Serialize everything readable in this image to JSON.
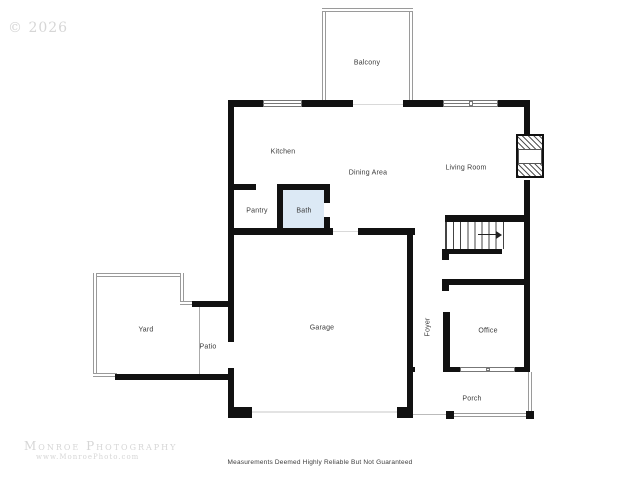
{
  "watermarks": {
    "copyright": "© 2026",
    "studio": "Monroe Photography",
    "studio_url": "www.MonroePhoto.com"
  },
  "disclaimer": "Measurements Deemed Highly Reliable But Not Guaranteed",
  "rooms": {
    "balcony": "Balcony",
    "kitchen": "Kitchen",
    "dining": "Dining Area",
    "living": "Living Room",
    "pantry": "Pantry",
    "bath": "Bath",
    "yard": "Yard",
    "patio": "Patio",
    "garage": "Garage",
    "foyer": "Foyer",
    "office": "Office",
    "porch": "Porch"
  },
  "colors": {
    "wall": "#111111",
    "bath_fill": "#dce9f5",
    "label": "#3a3a3a",
    "thin_line": "#9a9a9a",
    "watermark": "#d6d6d6"
  }
}
